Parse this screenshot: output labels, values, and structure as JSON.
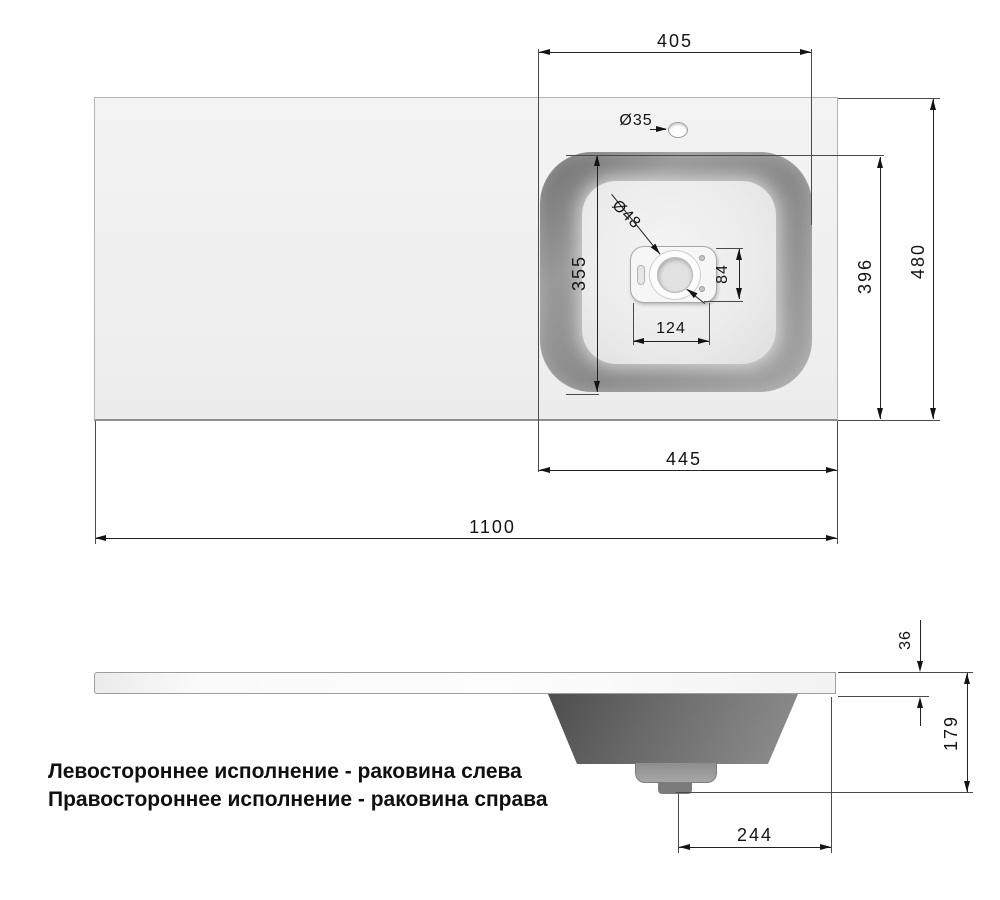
{
  "drawing": {
    "top_view": {
      "dim_405": "405",
      "dim_faucet": "Ø35",
      "dim_drain": "Ø48",
      "dim_355": "355",
      "dim_84": "84",
      "dim_124": "124",
      "dim_396": "396",
      "dim_480": "480",
      "dim_445": "445",
      "dim_1100": "1100"
    },
    "side_view": {
      "dim_36": "36",
      "dim_179": "179",
      "dim_244": "244"
    },
    "notes": {
      "line1": "Левостороннее исполнение - раковина слева",
      "line2": "Правостороннее исполнение - раковина справа"
    }
  }
}
